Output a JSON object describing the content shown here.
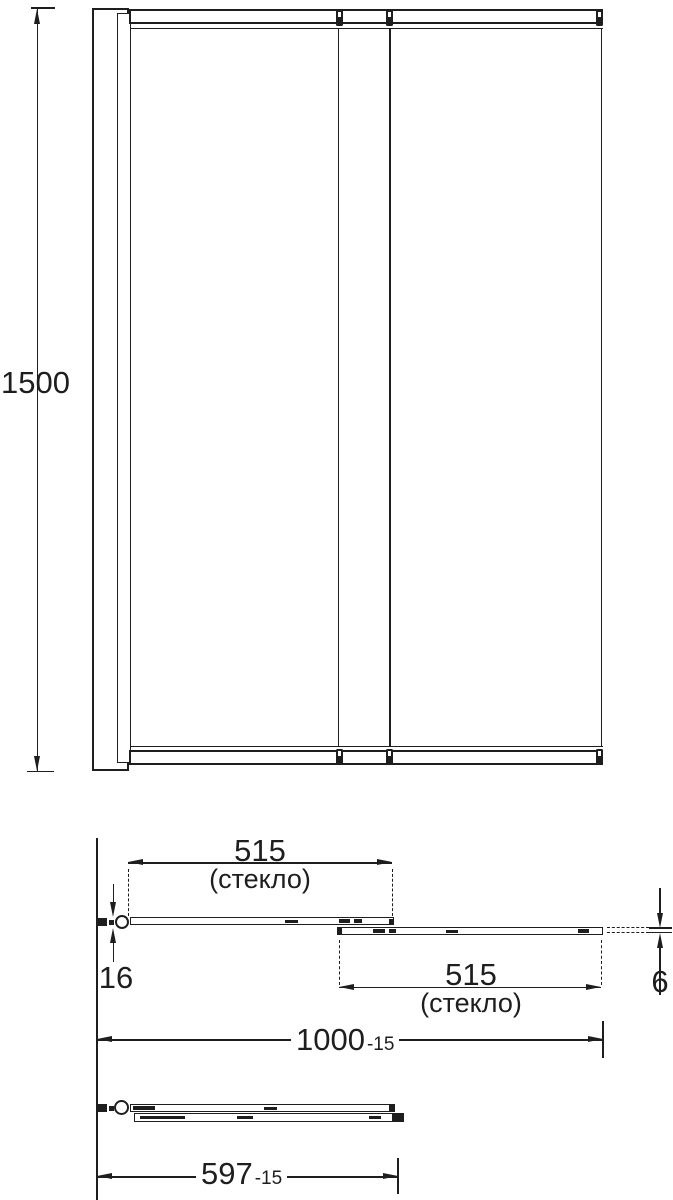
{
  "drawing": {
    "type": "technical-drawing",
    "subject": "sliding-bath-screen",
    "background": "#ffffff",
    "line_color": "#1e1e1e",
    "front_view": {
      "height_label": "1500"
    },
    "plan_open": {
      "glass1_width": "515",
      "glass1_note": "(стекло)",
      "glass2_width": "515",
      "glass2_note": "(стекло)",
      "profile_width": "16",
      "glass_thickness": "6",
      "overall_width": "1000",
      "overall_width_tolerance": "-15"
    },
    "plan_closed": {
      "folded_width": "597",
      "folded_width_tolerance": "-15"
    }
  }
}
